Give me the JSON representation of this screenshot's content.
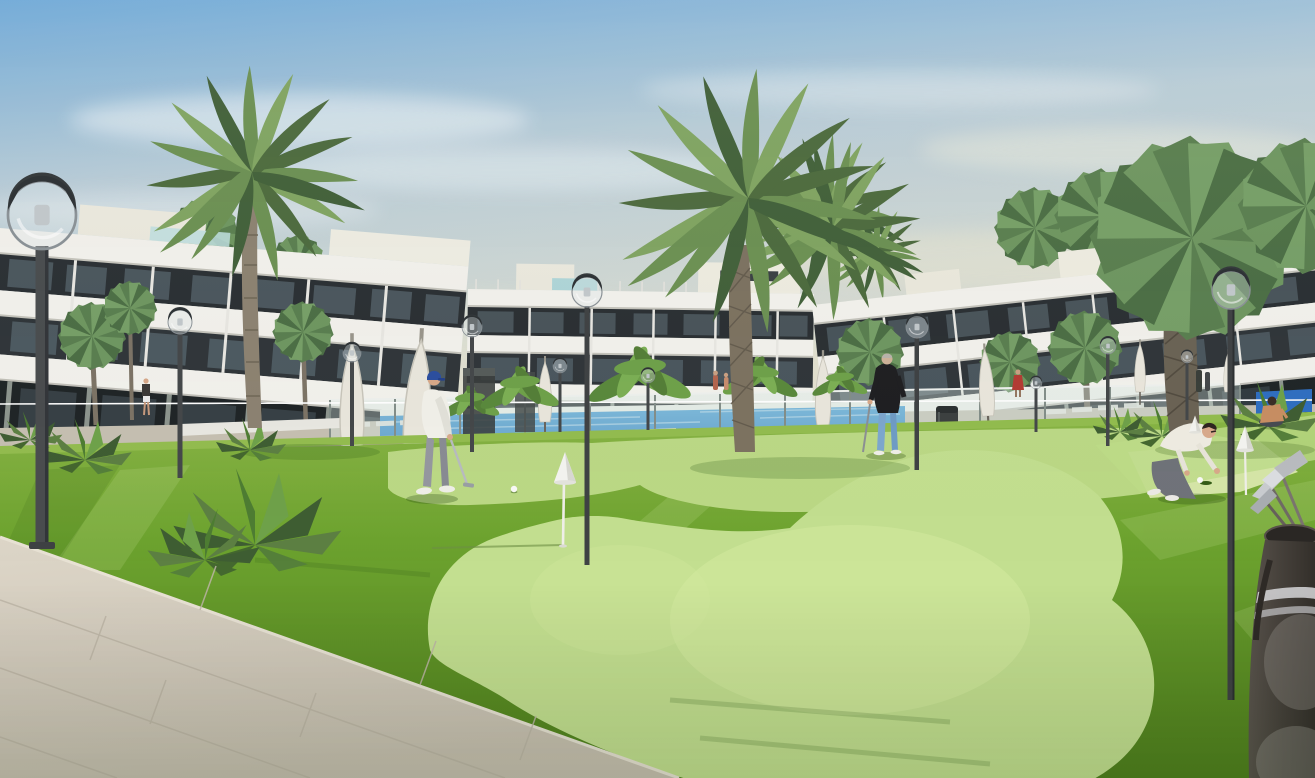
{
  "scene": {
    "title": "Exterior render: modern white apartment complex with putting green, pool and palm trees",
    "setting": "sunny residential resort, artificial-turf mini golf lawn in front of three 3-storey white apartment blocks with dark glazing bands",
    "objects": [
      "apartment-building-left",
      "apartment-building-center",
      "apartment-building-right",
      "rooftop-stair-boxes",
      "glass-pool-fence",
      "swimming-pool",
      "pool-deck",
      "closed-parasols",
      "sun-loungers",
      "banana-plants",
      "palm-trees",
      "fan-palms",
      "globe-street-lamps",
      "putting-green-clover",
      "tee-strip",
      "white-cone-markers",
      "golf-ball",
      "golf-hole",
      "tiled-walkway",
      "golf-bag-with-clubs",
      "litter-bin",
      "white-bench",
      "ping-pong-table",
      "garden-bushes"
    ],
    "people": [
      {
        "id": "golfer-putting",
        "pose": "putting stroke",
        "clothes": "blue cap, white polo, grey trousers, white shoes"
      },
      {
        "id": "man-standing-with-putter",
        "pose": "standing, club down",
        "clothes": "black sweater, light blue jeans"
      },
      {
        "id": "man-crouching-at-hole",
        "pose": "crouched, placing ball",
        "clothes": "cream t-shirt, grey trousers"
      },
      {
        "id": "woman-sitting-on-grass",
        "pose": "seated cross-legged near ping pong table",
        "clothes": "tan top"
      },
      {
        "id": "distant-walker-left",
        "pose": "walking by left building"
      },
      {
        "id": "distant-figures-right",
        "pose": "small figures near right building and pool edge"
      }
    ],
    "counts": {
      "buildings": 3,
      "large-date-palms": 2,
      "large-fan-palms": 1,
      "globe-lamps": 12,
      "cone-markers": 3,
      "golfers": 3
    },
    "palette": {
      "sky_top": "#6fa9d8",
      "sky_mid": "#b9cdd8",
      "sky_horizon": "#e3e1d0",
      "cloud": "#f2f6f7",
      "building_white": "#f3f2ed",
      "building_band_dark": "#2b3034",
      "building_ground": "#202527",
      "glass_teal": "#a8d4d8",
      "pool_water": "#2f86c8",
      "deck": "#c6c0b2",
      "fence_glass": "#d7e8e2",
      "grass_light_strip": "#93bd4f",
      "grass_base": "#6da32f",
      "grass_dark": "#4f7f1d",
      "green_putting": "#c3df90",
      "green_highlight": "#d2e99e",
      "walkway": "#d3ccbe",
      "walkway_line": "#bdb5a6",
      "palm_green": "#5d8052",
      "palm_green_dark": "#42613a",
      "trunk": "#8d8372",
      "trunk_dark": "#665e50",
      "lamp_metal": "#4a4d4f",
      "umbrella": "#eae7dd",
      "skin": "#d8a98a",
      "cap_blue": "#2b4fa0",
      "jeans_blue": "#7da7cf",
      "shirt_white": "#f2f1ea",
      "top_black": "#1f1f22",
      "bag_dark": "#45403a",
      "club_metal": "#c9ccd0",
      "cone_white": "#f4f4f0",
      "table_blue": "#2f6fc2"
    }
  }
}
